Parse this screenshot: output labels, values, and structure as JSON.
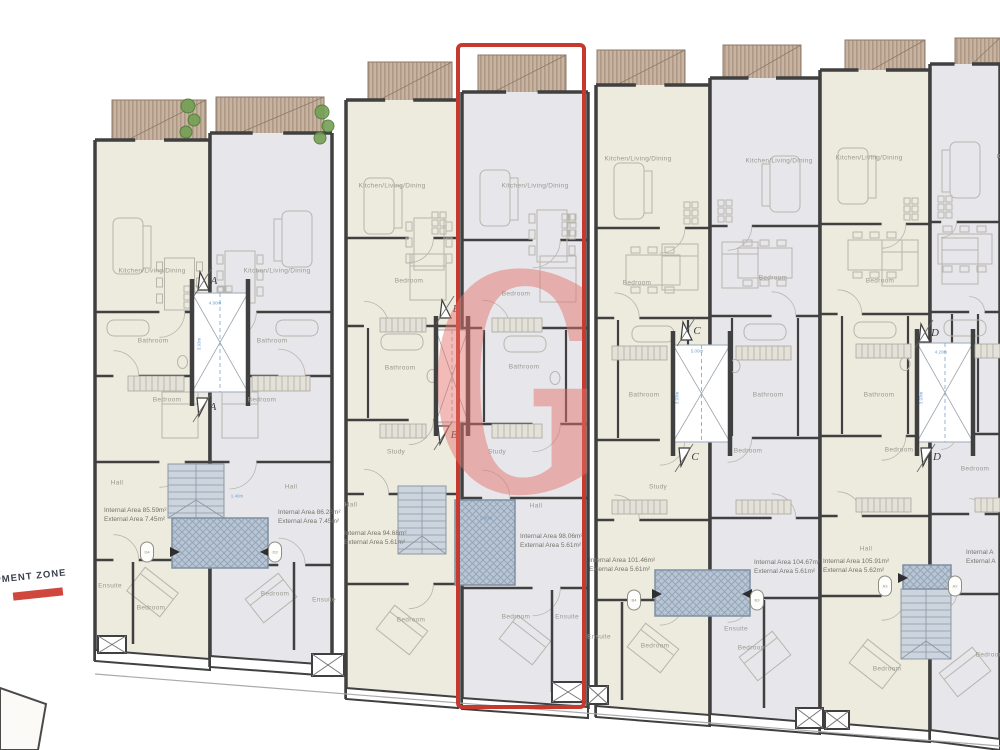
{
  "watermark": {
    "letter": "G"
  },
  "dev_zone": {
    "text": "PMENT ZONE"
  },
  "units": [
    {
      "name": "unit-1",
      "internal_area": "Internal Area 85.59m²",
      "external_area": "External Area 7.45m²",
      "highlighted": false
    },
    {
      "name": "unit-2",
      "internal_area": "Internal Area 86.28m²",
      "external_area": "External Area 7.45m²",
      "highlighted": false
    },
    {
      "name": "unit-3",
      "internal_area": "Internal Area 94.68m²",
      "external_area": "External Area 5.61m²",
      "highlighted": false
    },
    {
      "name": "unit-4",
      "internal_area": "Internal Area 98.06m²",
      "external_area": "External Area 5.61m²",
      "highlighted": true
    },
    {
      "name": "unit-5",
      "internal_area": "Internal Area 101.46m²",
      "external_area": "External Area 5.61m²",
      "highlighted": false
    },
    {
      "name": "unit-6",
      "internal_area": "Internal Area 104.67m²",
      "external_area": "External Area 5.61m²",
      "highlighted": false
    },
    {
      "name": "unit-7",
      "internal_area": "Internal Area 105.91m²",
      "external_area": "External Area 5.62m²",
      "highlighted": false
    },
    {
      "name": "unit-8",
      "internal_area": "Internal A",
      "external_area": "External A",
      "highlighted": false
    }
  ],
  "room_labels": [
    {
      "t": "Kitchen/Living/Dining",
      "x": 152,
      "y": 271
    },
    {
      "t": "Kitchen/Living/Dining",
      "x": 277,
      "y": 271
    },
    {
      "t": "Kitchen/Living/Dining",
      "x": 392,
      "y": 186
    },
    {
      "t": "Kitchen/Living/Dining",
      "x": 535,
      "y": 186
    },
    {
      "t": "Kitchen/Living/Dining",
      "x": 638,
      "y": 159
    },
    {
      "t": "Kitchen/Living/Dining",
      "x": 779,
      "y": 161
    },
    {
      "t": "Kitchen/Living/Dining",
      "x": 869,
      "y": 158
    },
    {
      "t": "Kitchen/Living/Dining",
      "x": 1030,
      "y": 157
    },
    {
      "t": "Bathroom",
      "x": 153,
      "y": 341
    },
    {
      "t": "Bathroom",
      "x": 272,
      "y": 341
    },
    {
      "t": "Bedroom",
      "x": 167,
      "y": 400
    },
    {
      "t": "Bedroom",
      "x": 262,
      "y": 400
    },
    {
      "t": "Hall",
      "x": 117,
      "y": 483
    },
    {
      "t": "Hall",
      "x": 291,
      "y": 487
    },
    {
      "t": "Ensuite",
      "x": 110,
      "y": 586
    },
    {
      "t": "Bedroom",
      "x": 151,
      "y": 608
    },
    {
      "t": "Bedroom",
      "x": 275,
      "y": 594
    },
    {
      "t": "Ensuite",
      "x": 324,
      "y": 600
    },
    {
      "t": "Bedroom",
      "x": 409,
      "y": 281
    },
    {
      "t": "Bedroom",
      "x": 516,
      "y": 294
    },
    {
      "t": "Bathroom",
      "x": 400,
      "y": 368
    },
    {
      "t": "Bathroom",
      "x": 524,
      "y": 367
    },
    {
      "t": "Study",
      "x": 396,
      "y": 452
    },
    {
      "t": "Study",
      "x": 497,
      "y": 452
    },
    {
      "t": "Hall",
      "x": 351,
      "y": 505
    },
    {
      "t": "Hall",
      "x": 536,
      "y": 506
    },
    {
      "t": "Bedroom",
      "x": 411,
      "y": 620
    },
    {
      "t": "Bedroom",
      "x": 516,
      "y": 617
    },
    {
      "t": "Ensuite",
      "x": 567,
      "y": 617
    },
    {
      "t": "Ensuite",
      "x": 599,
      "y": 637
    },
    {
      "t": "Bedroom",
      "x": 637,
      "y": 283
    },
    {
      "t": "Bedroom",
      "x": 773,
      "y": 278
    },
    {
      "t": "Bathroom",
      "x": 644,
      "y": 395
    },
    {
      "t": "Bathroom",
      "x": 768,
      "y": 395
    },
    {
      "t": "Study",
      "x": 658,
      "y": 487
    },
    {
      "t": "Bedroom",
      "x": 748,
      "y": 451
    },
    {
      "t": "Bedroom",
      "x": 655,
      "y": 646
    },
    {
      "t": "Bedroom",
      "x": 752,
      "y": 648
    },
    {
      "t": "Ensuite",
      "x": 736,
      "y": 629
    },
    {
      "t": "Bedroom",
      "x": 880,
      "y": 281
    },
    {
      "t": "Bathroom",
      "x": 879,
      "y": 395
    },
    {
      "t": "Bedroom",
      "x": 899,
      "y": 450
    },
    {
      "t": "Hall",
      "x": 866,
      "y": 549
    },
    {
      "t": "Bedroom",
      "x": 887,
      "y": 669
    },
    {
      "t": "Bedroom",
      "x": 975,
      "y": 469
    },
    {
      "t": "Bedroom",
      "x": 990,
      "y": 655
    }
  ],
  "section_markers": [
    {
      "letter": "A",
      "x": 198,
      "y": 272,
      "dir": "up"
    },
    {
      "letter": "A",
      "x": 197,
      "y": 398,
      "dir": "down"
    },
    {
      "letter": "B",
      "x": 440,
      "y": 300,
      "dir": "up"
    },
    {
      "letter": "B",
      "x": 438,
      "y": 426,
      "dir": "down"
    },
    {
      "letter": "C",
      "x": 681,
      "y": 322,
      "dir": "up"
    },
    {
      "letter": "C",
      "x": 679,
      "y": 448,
      "dir": "down"
    },
    {
      "letter": "D",
      "x": 919,
      "y": 324,
      "dir": "up"
    },
    {
      "letter": "D",
      "x": 921,
      "y": 448,
      "dir": "down"
    }
  ],
  "door_tags": [
    {
      "t": "D4",
      "x": 147,
      "y": 552
    },
    {
      "t": "D3",
      "x": 275,
      "y": 552
    },
    {
      "t": "B4",
      "x": 634,
      "y": 600
    },
    {
      "t": "B3",
      "x": 757,
      "y": 600
    },
    {
      "t": "A3",
      "x": 885,
      "y": 586
    },
    {
      "t": "A2",
      "x": 955,
      "y": 586
    }
  ],
  "dimensions": [
    {
      "t": "4.90m",
      "x": 215,
      "y": 303,
      "rot": 0
    },
    {
      "t": "3.93m",
      "x": 199,
      "y": 344,
      "rot": -90
    },
    {
      "t": "5.00m",
      "x": 697,
      "y": 351,
      "rot": 0
    },
    {
      "t": "3.93m",
      "x": 677,
      "y": 398,
      "rot": -90
    },
    {
      "t": "4.20m",
      "x": 941,
      "y": 352,
      "rot": 0
    },
    {
      "t": "3.93m",
      "x": 921,
      "y": 398,
      "rot": -90
    },
    {
      "t": "1.40m",
      "x": 237,
      "y": 496,
      "rot": 0
    },
    {
      "t": "1.40m",
      "x": 486,
      "y": 518,
      "rot": 0
    }
  ],
  "colors": {
    "beige": "#edeade",
    "gray": "#e7e7eb",
    "wall": "#404040",
    "terrace_fill": "#c7b3a2",
    "terrace_stripe": "#af9884",
    "terrace_edge": "#8d7a69",
    "stair": "#ccd4dd",
    "stair_line": "#8c98a6",
    "hatch": "#b9c5d3",
    "hatch_line": "#94a6ba",
    "lightwell_line": "#a8b6c6",
    "highlight_red": "#c5392f",
    "watermark_pink": "#e4726b",
    "accent_red": "#d0473d",
    "label_gray": "#9b9890",
    "dim_blue": "#6f9fcc",
    "plant_green": "#74a055",
    "furn": "#b8b6ac"
  }
}
